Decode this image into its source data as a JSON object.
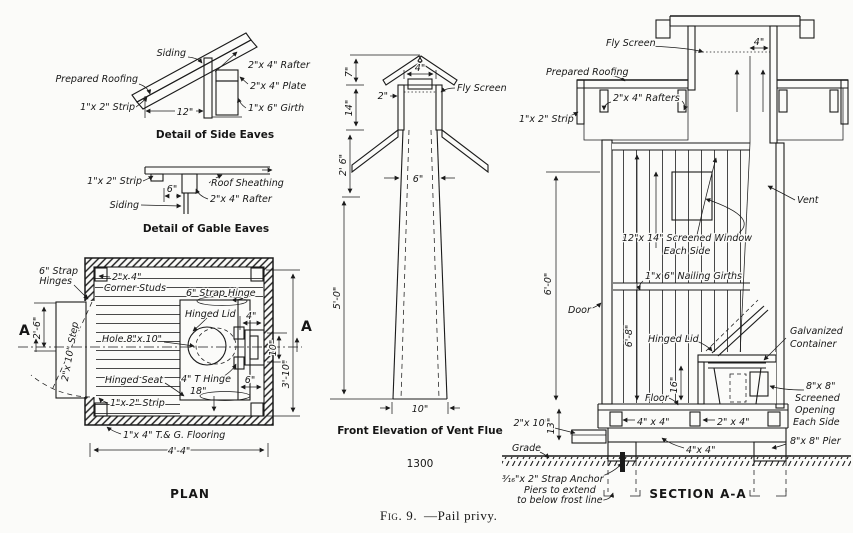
{
  "page": {
    "paper_color": "#fbfbf9",
    "ink_color": "#1b1b1b"
  },
  "figure": {
    "caption_prefix": "Fig. 9.",
    "caption_rest": "—Pail privy."
  },
  "side_eaves": {
    "title": "Detail of Side Eaves",
    "labels": {
      "siding": "Siding",
      "prepared_roofing": "Prepared Roofing",
      "strip": "1\"x 2\" Strip",
      "rafter": "2\"x 4\" Rafter",
      "plate": "2\"x 4\" Plate",
      "girth": "1\"x 6\" Girth",
      "dim_12": "12\""
    }
  },
  "gable_eaves": {
    "title": "Detail of Gable Eaves",
    "labels": {
      "strip": "1\"x 2\" Strip",
      "siding": "Siding",
      "sheathing": "Roof Sheathing",
      "rafter": "2\"x 4\" Rafter",
      "dim_6": "6\""
    }
  },
  "plan": {
    "title": "PLAN",
    "labels": {
      "strap_hinges_l1": "6\" Strap",
      "strap_hinges_l2": "Hinges",
      "corner_studs_l1": "2\"x 4\"",
      "corner_studs_l2": "Corner Studs",
      "strap_hinge": "6\" Strap Hinge",
      "hinged_lid": "Hinged Lid",
      "hole": "Hole 8\"x 10\"",
      "hinged_seat": "Hinged Seat",
      "t_hinge": "4\" T Hinge",
      "dim_18": "18\"",
      "dim_6": "6\"",
      "dim_4": "4\"",
      "dim_10": "10\"",
      "dim_3_10": "3'-10\"",
      "dim_2_6": "2'-6\"",
      "step": "2\"x 10\" Step",
      "strip": "1\"x 2\" Strip",
      "flooring": "1\"x 4\" T.& G. Flooring",
      "dim_4_4": "4'-4\"",
      "marker_left": "A",
      "marker_right": "A"
    }
  },
  "vent_flue": {
    "title": "Front Elevation of Vent Flue",
    "figure_number": "1300",
    "labels": {
      "fly_screen": "Fly Screen",
      "dim_7": "7\"",
      "dim_14": "14\"",
      "dim_2_6": "2' 6\"",
      "dim_4": "4\"",
      "dim_2": "2\"",
      "dim_6": "6\"",
      "dim_5_0": "5'-0\"",
      "dim_10": "10\""
    }
  },
  "section": {
    "title": "SECTION A-A",
    "labels": {
      "fly_screen": "Fly Screen",
      "dim_4": "4\"",
      "prepared_roofing": "Prepared Roofing",
      "rafters": "2\"x 4\" Rafters",
      "strip": "1\"x 2\" Strip",
      "vent": "Vent",
      "window_l1": "12\"x 14\" Screened Window",
      "window_l2": "Each Side",
      "girths": "1\"x 6\" Nailing Girths",
      "dim_6_0": "6'-0\"",
      "door": "Door",
      "dim_6_8": "6'-8\"",
      "hinged_lid": "Hinged Lid",
      "galvanized_l1": "Galvanized",
      "galvanized_l2": "Container",
      "dim_16": "16\"",
      "floor": "Floor",
      "opening_l1": "8\"x 8\"",
      "opening_l2": "Screened",
      "opening_l3": "Opening",
      "opening_l4": "Each Side",
      "dim_2x10": "2\"x 10\"",
      "dim_13": "13\"",
      "skid_4x4": "4\" x 4\"",
      "sill_2x4": "2\" x 4\"",
      "runner_4x4": "4\"x 4\"",
      "pier": "8\"x 8\" Pier",
      "grade": "Grade",
      "strap_anchor": "³⁄₁₆\"x 2\" Strap Anchor",
      "piers_l1": "Piers to extend",
      "piers_l2": "to below frost line"
    }
  }
}
